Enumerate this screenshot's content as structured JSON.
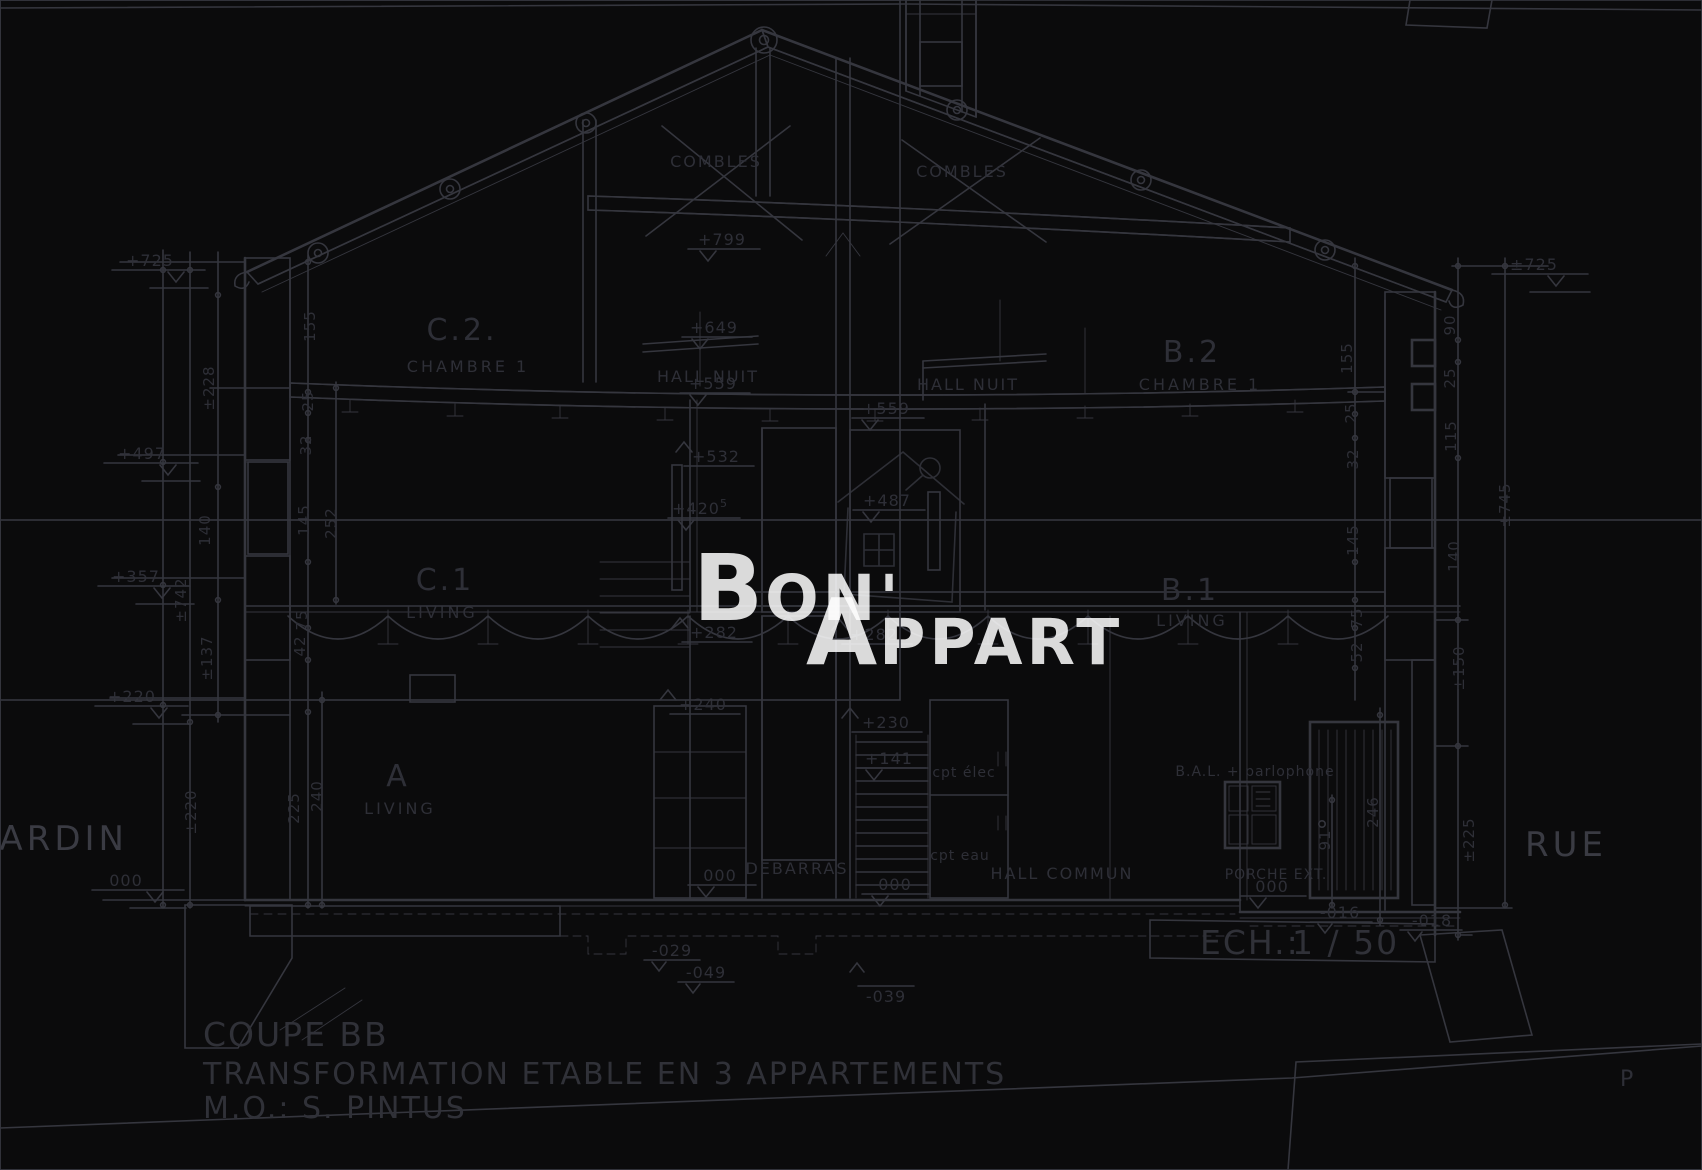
{
  "title_block": {
    "drawing_name": "COUPE BB",
    "project": "TRANSFORMATION ETABLE EN 3 APPARTEMENTS",
    "owner": "M.O.:  S. PINTUS",
    "scale_label": "ECH.:",
    "scale_value": "1 / 50"
  },
  "site_labels": {
    "left": "JARDIN",
    "right": "RUE"
  },
  "corner_mark": "P",
  "watermark": {
    "b": "B",
    "on": "ON'",
    "a": "A",
    "ppart": "PPART"
  },
  "rooms": {
    "combles_left": "COMBLES",
    "combles_right": "COMBLES",
    "c2": "C.2.",
    "c2_sub": "CHAMBRE 1",
    "b2": "B.2",
    "b2_sub": "CHAMBRE 1",
    "hall_nuit_left": "HALL NUIT",
    "hall_nuit_right": "HALL NUIT",
    "c1": "C.1",
    "c1_sub": "LIVING",
    "b1": "B.1",
    "b1_sub": "LIVING",
    "a": "A",
    "a_sub": "LIVING",
    "debarras": "DEBARRAS",
    "hall_commun": "HALL COMMUN",
    "porche": "PORCHE EXT.",
    "cpt_elec": "cpt élec",
    "cpt_eau": "cpt eau",
    "bal": "B.A.L. + parlophone"
  },
  "levels": {
    "l799": "+799",
    "l649": "+649",
    "l559a": "+559",
    "l559b": "+559",
    "l532": "+532",
    "l487": "+487",
    "l420": "+420",
    "l420sup": "5",
    "l282a": "+282",
    "l282b": "+282",
    "l240": "+240",
    "l230": "+230",
    "l141": "+141",
    "zero_jardin": "000",
    "zero_a": "000",
    "zero_stair": "000",
    "zero_porche": "000",
    "m029": "-029",
    "m049": "-049",
    "m039": "-039",
    "m016": "-016",
    "m018": "-018"
  },
  "elevations_left": {
    "e725": "+725",
    "e497": "+497",
    "e357": "+357",
    "e220": "+220"
  },
  "elevations_right": {
    "e725": "±725"
  },
  "dims_left": {
    "v742": "±742",
    "v220": "±220",
    "v228": "±228",
    "v137": "±137",
    "s155": "155",
    "s25": "25",
    "s32": "32",
    "s145": "145",
    "s252": "252",
    "s75": "75",
    "s42": "42",
    "s225": "225",
    "s240": "240"
  },
  "dims_right": {
    "r155": "155",
    "r25": "25",
    "r32": "32",
    "r145": "145",
    "r75": "75",
    "r52": "52",
    "r90": "90",
    "r25b": "25",
    "r115": "115",
    "r140": "140",
    "r150": "±150",
    "r225": "±225",
    "r745": "±745",
    "r246": "246",
    "r91": "91"
  }
}
